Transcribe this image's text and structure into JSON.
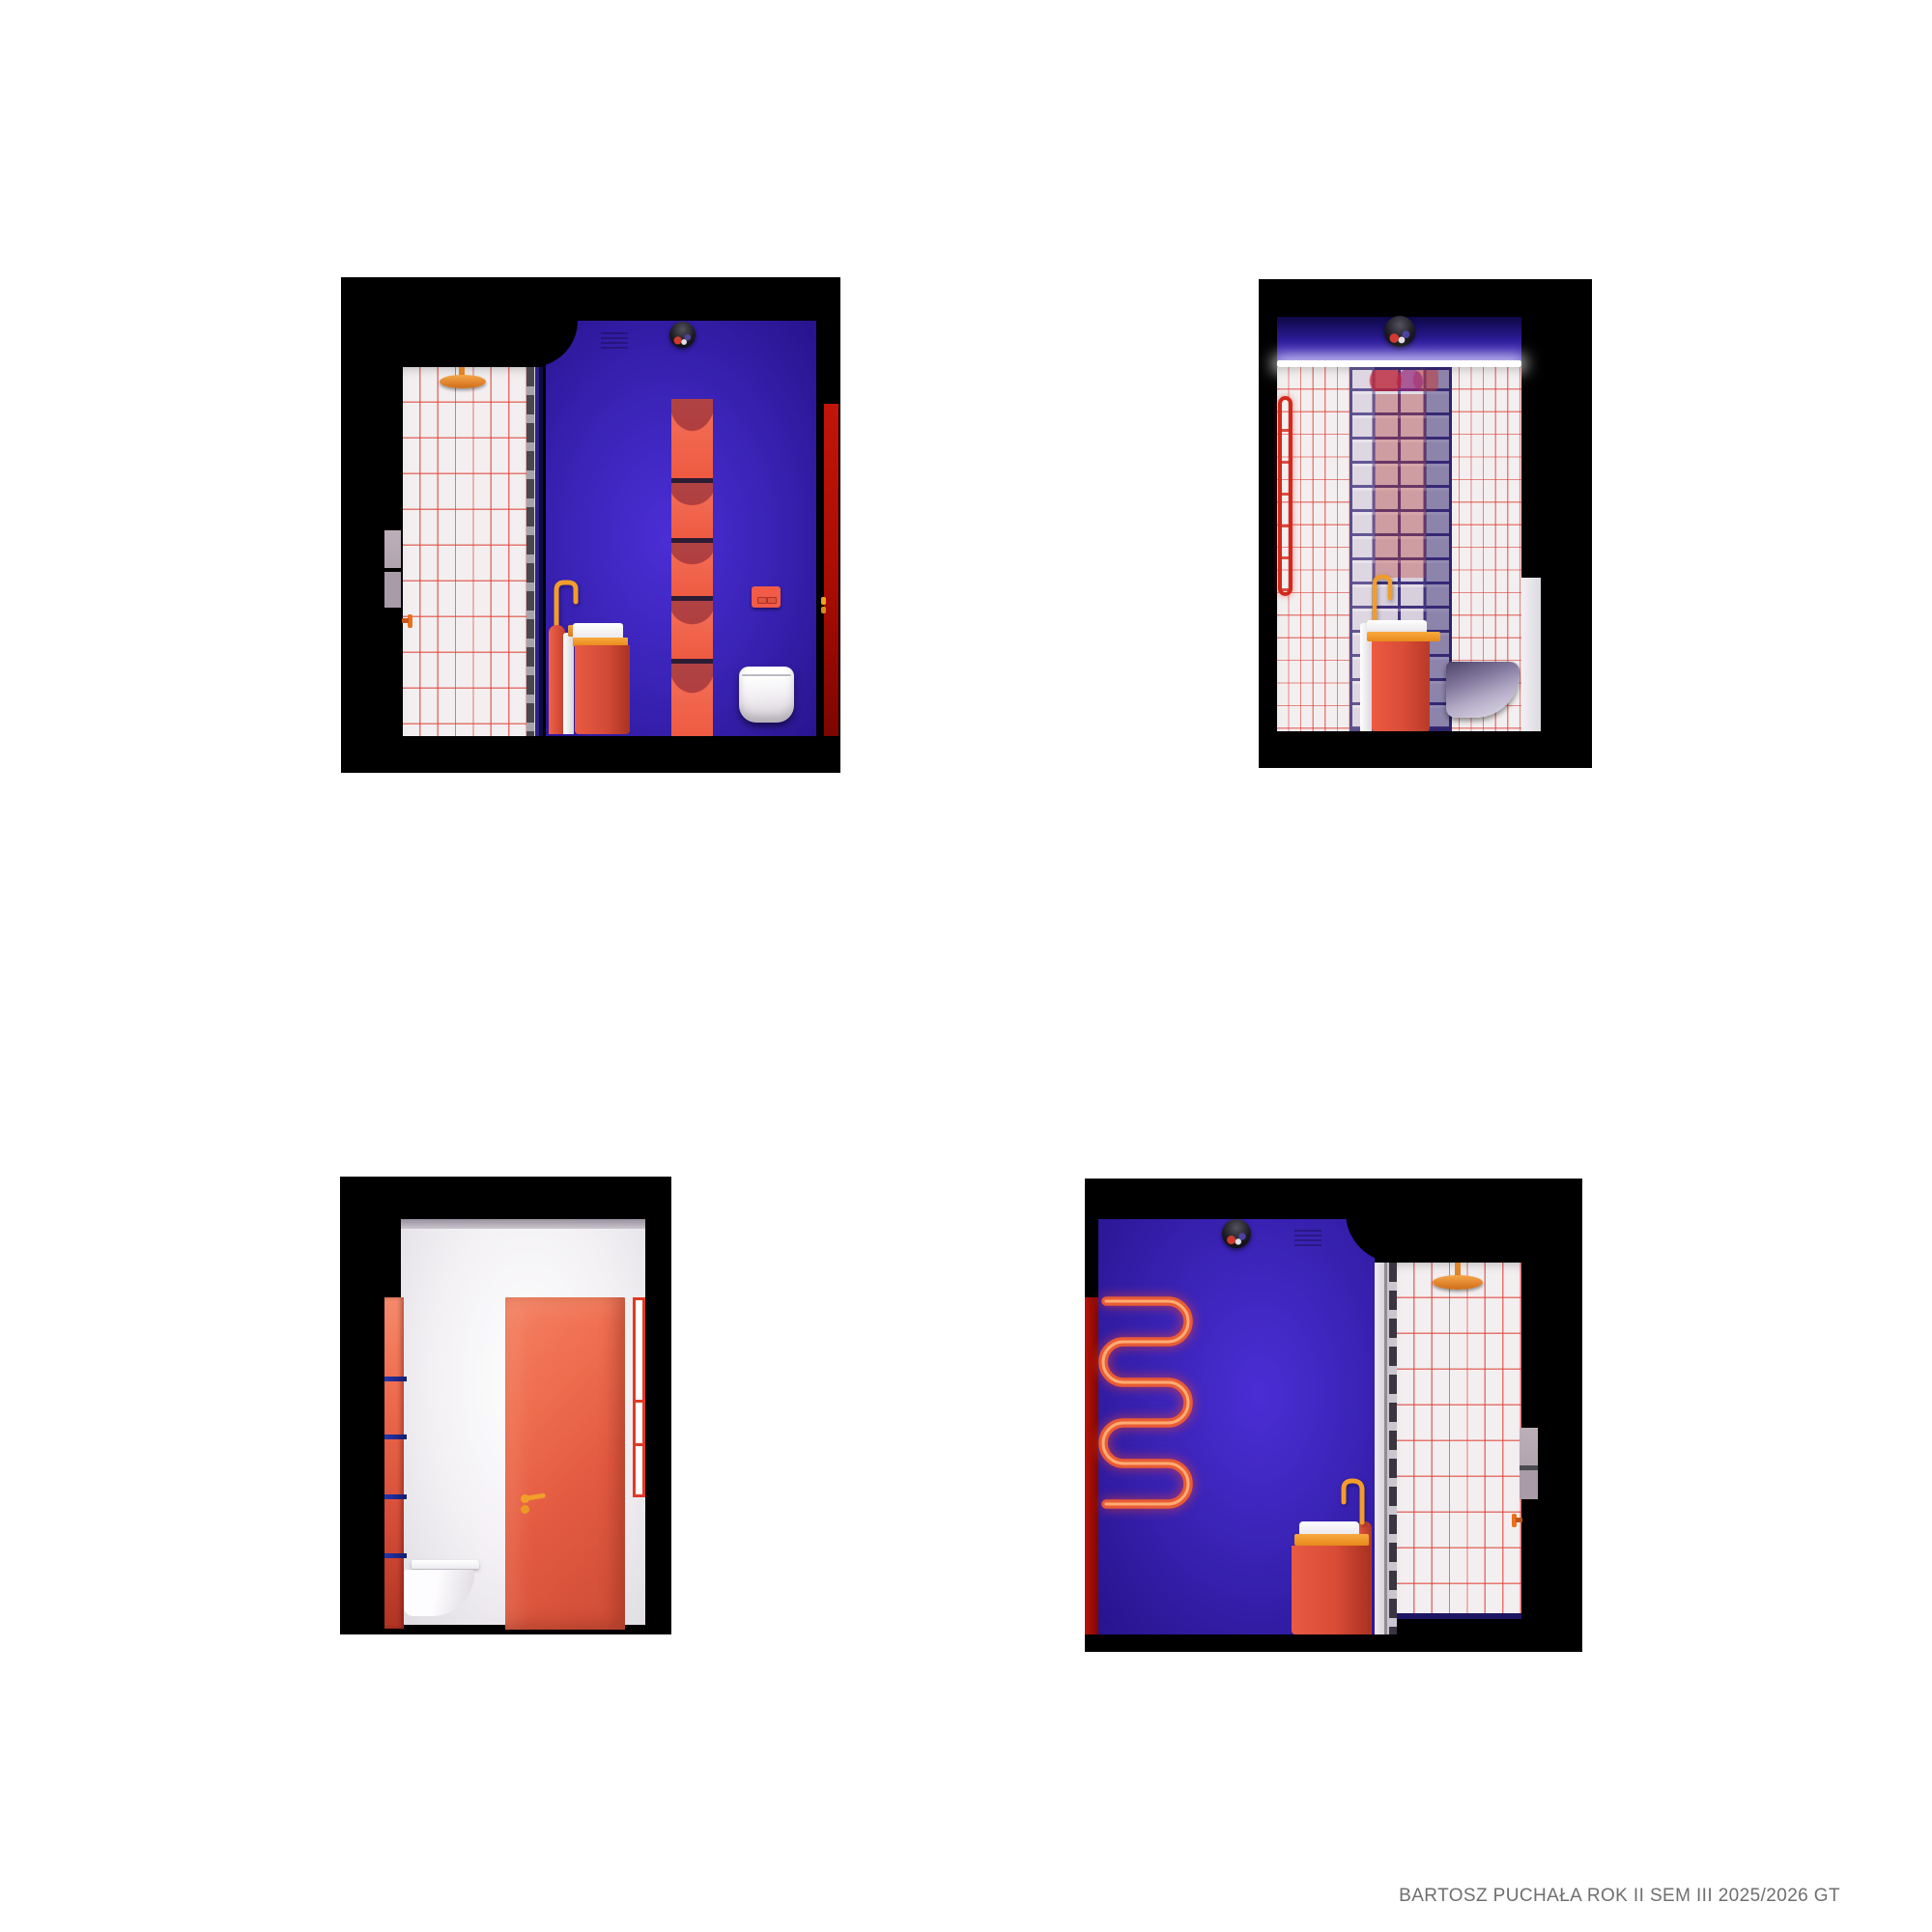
{
  "caption": {
    "text": "BARTOSZ PUCHAŁA ROK II SEM III 2025/2026 GT"
  },
  "palette": {
    "page_bg": "#ffffff",
    "frame": "#000000",
    "purple": "#3a23b6",
    "purple_light": "#4b2ed5",
    "purple_dark": "#27138c",
    "coral": "#ee5c45",
    "coral_light": "#f58a6b",
    "coral_dark": "#c23b2a",
    "dark_red": "#a80c03",
    "orange": "#f0951f",
    "orange_deep": "#d9741f",
    "tile": "#f3eff0",
    "tile_grid": "#e0443a",
    "lavender": "#b7a9b3",
    "mortar": "#41337e",
    "navy": "#1d1665",
    "blue_shelf": "#1c2da6",
    "glass": "#d7cfdb",
    "caption_gray": "#6f6f6f"
  },
  "panels": {
    "top_left": {
      "id": "elevation-shower-sink-wc",
      "objects": [
        "rain-shower-head",
        "tiled-shower-wall",
        "glass-partition",
        "purple-feature-wall",
        "mirror-ball-pendant-light",
        "ceiling-vent",
        "pedestal-washbasin",
        "gooseneck-faucet",
        "soap-dispenser",
        "recessed-shelf-column",
        "flush-plate",
        "wall-hung-toilet",
        "red-door-edge",
        "wall-switch-panels",
        "water-valve"
      ]
    },
    "top_right": {
      "id": "elevation-glass-block-wall",
      "objects": [
        "mirror-ball-pendant-light",
        "led-cove-light",
        "tiled-wall",
        "glass-block-column",
        "towel-radiator-side",
        "pedestal-washbasin",
        "gooseneck-faucet",
        "wall-hung-toilet-side",
        "door-opening"
      ]
    },
    "bottom_left": {
      "id": "elevation-entrance-door",
      "objects": [
        "entrance-door",
        "door-handle",
        "open-shelf-column-side",
        "wall-hung-toilet-side",
        "shelf-side-panel"
      ]
    },
    "bottom_right": {
      "id": "elevation-radiator-shower",
      "objects": [
        "mirror-ball-pendant-light",
        "ceiling-vent",
        "serpentine-towel-radiator",
        "purple-feature-wall",
        "pedestal-washbasin",
        "gooseneck-faucet",
        "glass-partition",
        "tiled-shower-wall",
        "rain-shower-head",
        "wall-switch-panels",
        "water-valve",
        "red-door-edge"
      ]
    }
  }
}
